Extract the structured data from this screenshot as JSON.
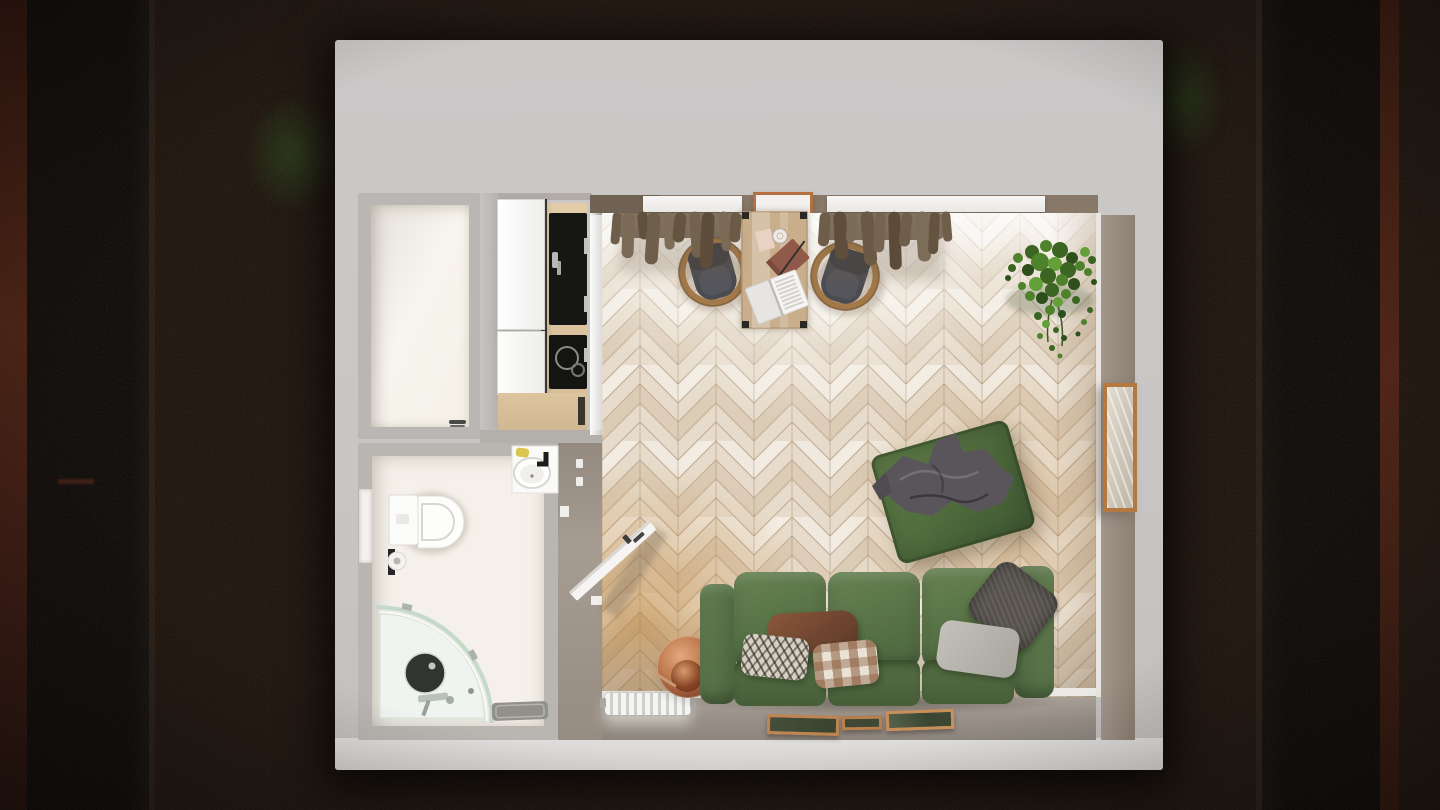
{
  "scene": {
    "description": "top-down 3d render of a studio apartment at night",
    "view": "top-down",
    "rooms": [
      {
        "name": "entry-closet",
        "floor": "white"
      },
      {
        "name": "bathroom",
        "fixtures": [
          "toilet",
          "toilet-paper-holder",
          "corner-shower",
          "shower-drain",
          "washbasin",
          "soap-bar",
          "bath-mat",
          "wall-niche"
        ]
      },
      {
        "name": "kitchen",
        "fixtures": [
          "tall-white-cabinets",
          "wood-counter",
          "black-sink",
          "induction-cooktop",
          "base-cabinet",
          "chrome-handles"
        ]
      },
      {
        "name": "living-room",
        "fixtures": [
          "herringbone-parquet",
          "two-windows",
          "curtains",
          "wall-shelf",
          "dining-table",
          "dining-chair",
          "dining-chair",
          "laptop",
          "notebook",
          "drinking-glass",
          "paper-card",
          "hanging-plant",
          "leaning-mirror",
          "green-ottoman",
          "gray-blanket",
          "green-sofa",
          "pillows",
          "radiator",
          "copper-side-table",
          "copper-cup",
          "picture-frames",
          "open-door"
        ]
      }
    ],
    "counts": {
      "chairs": 2,
      "windows": 2,
      "pillows": 5,
      "picture_frames": 3,
      "radiator_fins": 11,
      "sofa_seats": 3
    },
    "palette": {
      "night_ground": "#170e09",
      "building_wall": "#c9c7c5",
      "interior_wall_taupe": "#887868",
      "bathroom_floor": "#f5f1ea",
      "parquet_light": "#e7dccb",
      "parquet_gold": "#c0843a",
      "sofa_green": "#5a7547",
      "ottoman_green": "#4e6a3c",
      "blanket_gray": "#5a555a",
      "curtain_brown": "#6a5946",
      "chair_seat_gray": "#4b4b52",
      "chair_frame_wood": "#a3794a",
      "table_wood": "#c9ae8b",
      "appliance_black": "#151513",
      "copper": "#c07b50",
      "radiator_white": "#f4f4f2",
      "mirror_frame": "#b5793f",
      "frame_glass_green": "#3e4834",
      "plant_green": "#4f822c"
    }
  }
}
